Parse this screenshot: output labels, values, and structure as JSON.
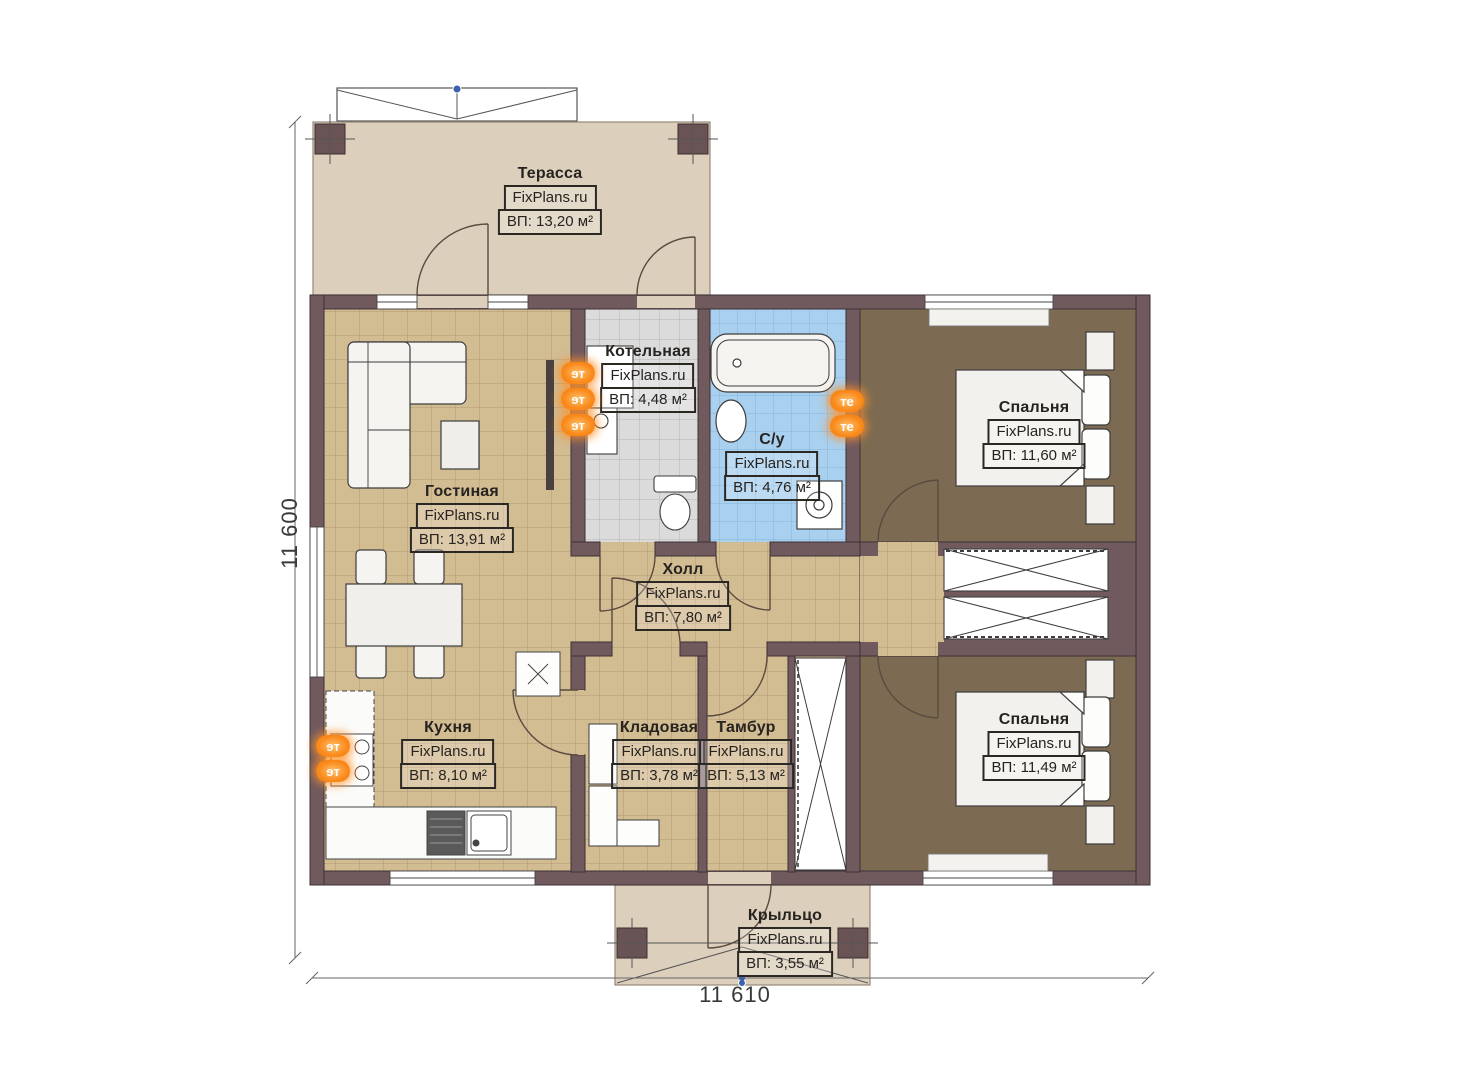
{
  "plan": {
    "rooms": [
      {
        "name": "Терасса",
        "brand": "FixPlans.ru",
        "area": "ВП: 13,20 м²"
      },
      {
        "name": "Котельная",
        "brand": "FixPlans.ru",
        "area": "ВП: 4,48 м²"
      },
      {
        "name": "С/у",
        "brand": "FixPlans.ru",
        "area": "ВП: 4,76 м²"
      },
      {
        "name": "Спальня",
        "brand": "FixPlans.ru",
        "area": "ВП: 11,60 м²"
      },
      {
        "name": "Гостиная",
        "brand": "FixPlans.ru",
        "area": "ВП: 13,91 м²"
      },
      {
        "name": "Холл",
        "brand": "FixPlans.ru",
        "area": "ВП: 7,80 м²"
      },
      {
        "name": "Кухня",
        "brand": "FixPlans.ru",
        "area": "ВП: 8,10 м²"
      },
      {
        "name": "Кладовая",
        "brand": "FixPlans.ru",
        "area": "ВП: 3,78 м²"
      },
      {
        "name": "Тамбур",
        "brand": "FixPlans.ru",
        "area": "ВП: 5,13 м²"
      },
      {
        "name": "Спальня",
        "brand": "FixPlans.ru",
        "area": "ВП: 11,49 м²"
      },
      {
        "name": "Крыльцо",
        "brand": "FixPlans.ru",
        "area": "ВП: 3,55 м²"
      }
    ],
    "dimensions": {
      "height_total": "11 600",
      "width_total": "11 610"
    },
    "markers": {
      "heater_label": "те"
    },
    "colors": {
      "wall": "#715a5e",
      "tile_tan": "#d2bc92",
      "tile_grey": "#dbdbdb",
      "tile_blue": "#a9d0ee",
      "carpet": "#7c6b52",
      "deck": "#dcd0bc",
      "accent_orange": "#f98a1c"
    }
  }
}
